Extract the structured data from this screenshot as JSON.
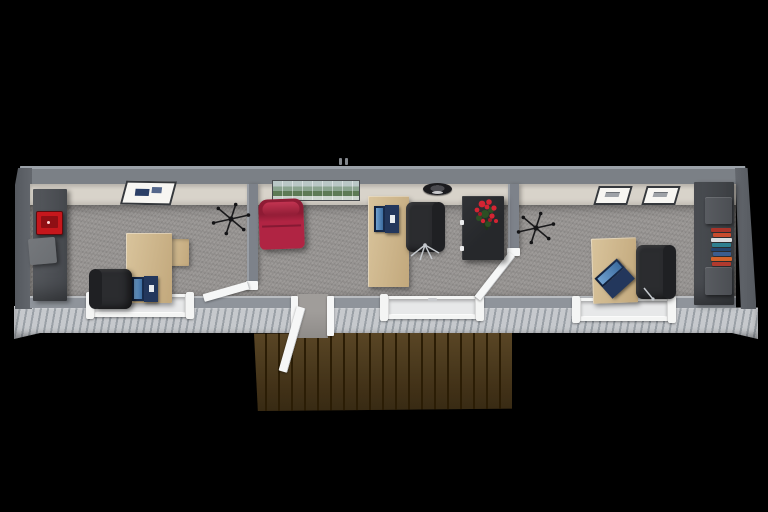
{
  "palette": {
    "background": "#000000",
    "roof_gray": "#7b8086",
    "roof_lip": "#9ba1a8",
    "wall_end": "#63676d",
    "wall_face": "#d8d3ca",
    "carpet": "#9a9795",
    "south_wall": "#8f949b",
    "siding": "#c6c9cd",
    "siding_groove": "#9aa0a6",
    "trim_white": "#f4f5f4",
    "door_white": "#f6f7f7",
    "deck_plank": "#48320e",
    "deck_groove": "#2b1d05",
    "partition": "#7d828a",
    "desk_wood": "#d9c49c",
    "desk_wood_dark": "#c2a87c",
    "cabinet_dark": "#46494e",
    "cabinet_light": "#55585d",
    "island_dark": "#26282b",
    "chair_black": "#2b2c2f",
    "chair_back": "#1f2023",
    "chrome": "#c3c7cc",
    "laptop_lid": "#1b2f52",
    "laptop_base": "#23375c",
    "laptop_screen": "#3d6da0",
    "laptop_keys": "#b9c6d4",
    "accent_red": "#c6171c",
    "gray_box": "#6b6e72",
    "red_chair": "#b02443",
    "red_chair_dark": "#8e1b34",
    "flower_red": "#d42433",
    "leaf_green": "#2c4f24",
    "clock_dark": "#1b1b1e",
    "art_sky": "#b9c7c6",
    "art_trees": "#5d7a55",
    "art_water": "#cdd6cf",
    "frame_white": "#f7f6f2",
    "frame_border": "#35383c",
    "book_1": "#a8342a",
    "book_2": "#c74b2e",
    "book_3": "#d9dde0",
    "book_4": "#2e7f8f",
    "book_5": "#24456e",
    "book_6": "#3b5d8e",
    "book_7": "#d2622a",
    "book_8": "#b03a2e"
  },
  "scene": {
    "view": "top-down 3D floor-plan render of a long modular container office on a black background",
    "building": {
      "exterior": [
        "gray metal walls",
        "corrugated light-gray siding",
        "small roof vent"
      ],
      "rooms": [
        {
          "name": "left office",
          "items": [
            "dark storage cabinet",
            "red printer",
            "gray storage box",
            "abstract wall art",
            "ceiling fan",
            "l-shaped wood desk",
            "open laptop",
            "black office chair",
            "front window"
          ]
        },
        {
          "name": "center office",
          "items": [
            "red lounge chair",
            "panoramic landscape wall art",
            "wall clock",
            "wood desk",
            "open laptop",
            "black office chair",
            "dark sideboard",
            "red flower arrangement",
            "front window",
            "entry door open to deck"
          ]
        },
        {
          "name": "right office",
          "items": [
            "ceiling fan",
            "two framed prints",
            "wood desk",
            "open laptop",
            "black office chair",
            "dark shelf cabinet",
            "stack of colorful books",
            "front window"
          ]
        }
      ],
      "doors": [
        "front entry door swung open onto deck",
        "left interior door",
        "right interior door"
      ]
    },
    "deck": {
      "material": "dark brown wood planks",
      "position": "front center"
    }
  }
}
